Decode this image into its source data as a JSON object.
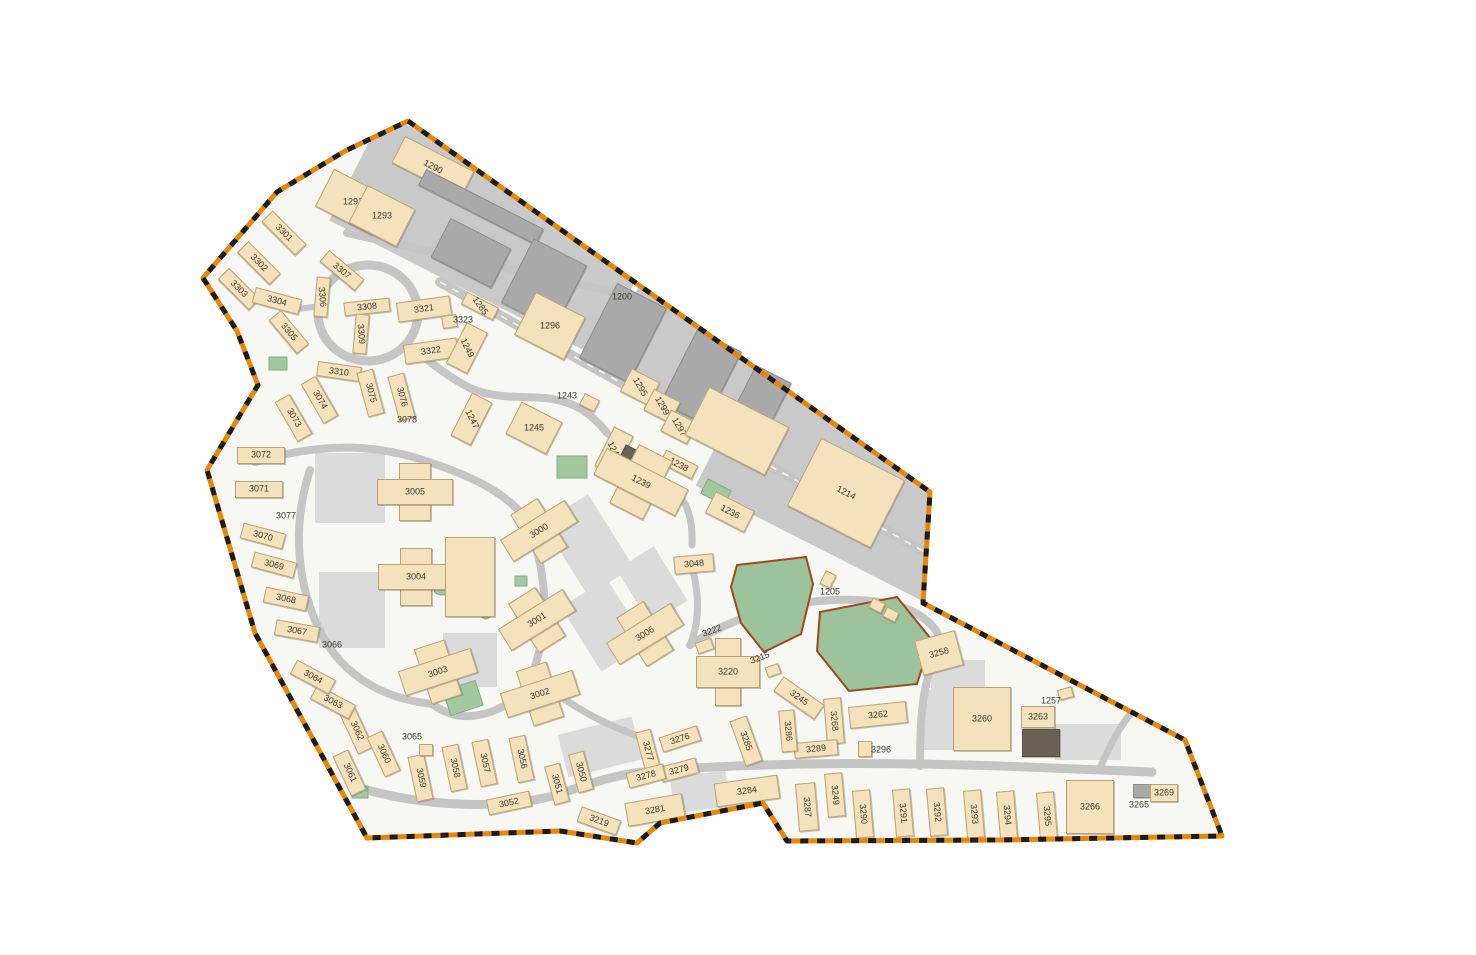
{
  "title": "Installation base site map with numbered buildings and dashed boundary",
  "colors": {
    "boundary_orange": "#e8860b",
    "boundary_black": "#1c1c1c",
    "ground": "#f7f7f3",
    "industrial_gray": "#c9c9c9",
    "road_gray": "#c5c5c5",
    "parking_gray": "#dbdbdb",
    "building_tan": "#f3e2bb",
    "building_border": "#b9a376",
    "warehouse_gray": "#a9a9a9",
    "dark_building": "#6b6257",
    "field_green": "#9cc39b",
    "field_border": "#9c4a1f",
    "label_text": "#3e3a31"
  },
  "map": {
    "buildings": [
      {
        "t": "1290",
        "x": 432,
        "y": 166,
        "w": 76,
        "h": 28,
        "r": 27,
        "la": 27
      },
      {
        "t": "1291",
        "x": 352,
        "y": 201,
        "w": 62,
        "h": 40,
        "r": 27,
        "la": 0
      },
      {
        "t": "1293",
        "x": 381,
        "y": 215,
        "w": 52,
        "h": 40,
        "r": 27,
        "la": 0
      },
      {
        "t": "",
        "x": 480,
        "y": 206,
        "w": 130,
        "h": 16,
        "r": 27,
        "k": "g"
      },
      {
        "t": "",
        "x": 470,
        "y": 252,
        "w": 66,
        "h": 42,
        "r": 27,
        "k": "g"
      },
      {
        "t": "",
        "x": 543,
        "y": 283,
        "w": 58,
        "h": 70,
        "r": 27,
        "k": "g"
      },
      {
        "t": "",
        "x": 622,
        "y": 332,
        "w": 54,
        "h": 82,
        "r": 27,
        "k": "g"
      },
      {
        "t": "",
        "x": 700,
        "y": 376,
        "w": 48,
        "h": 80,
        "r": 27,
        "k": "g"
      },
      {
        "t": "",
        "x": 756,
        "y": 406,
        "w": 38,
        "h": 72,
        "r": 27,
        "k": "g"
      },
      {
        "t": "3301",
        "x": 283,
        "y": 232,
        "w": 46,
        "h": 14,
        "r": 45,
        "la": 45
      },
      {
        "t": "3302",
        "x": 258,
        "y": 262,
        "w": 44,
        "h": 14,
        "r": 45,
        "la": 45
      },
      {
        "t": "3303",
        "x": 238,
        "y": 288,
        "w": 42,
        "h": 14,
        "r": 45,
        "la": 45
      },
      {
        "t": "3304",
        "x": 276,
        "y": 300,
        "w": 46,
        "h": 14,
        "r": 15,
        "la": 15
      },
      {
        "t": "3305",
        "x": 288,
        "y": 331,
        "w": 42,
        "h": 14,
        "r": 50,
        "la": 50
      },
      {
        "t": "3307",
        "x": 341,
        "y": 269,
        "w": 44,
        "h": 13,
        "r": 40,
        "la": 40
      },
      {
        "t": "3306",
        "x": 321,
        "y": 296,
        "w": 12,
        "h": 38,
        "r": 5,
        "la": 85
      },
      {
        "t": "3308",
        "x": 366,
        "y": 306,
        "w": 44,
        "h": 12,
        "r": -6,
        "la": -6
      },
      {
        "t": "3309",
        "x": 360,
        "y": 333,
        "w": 12,
        "h": 38,
        "r": 5,
        "la": 85
      },
      {
        "t": "3310",
        "x": 338,
        "y": 370,
        "w": 42,
        "h": 13,
        "r": 8,
        "la": 8
      },
      {
        "t": "3321",
        "x": 423,
        "y": 308,
        "w": 52,
        "h": 18,
        "r": -8,
        "la": -8
      },
      {
        "t": "",
        "x": 448,
        "y": 320,
        "w": 13,
        "h": 11,
        "r": -8
      },
      {
        "t": "3323",
        "x": 463,
        "y": 320,
        "k": "l",
        "la": 0
      },
      {
        "t": "3322",
        "x": 430,
        "y": 350,
        "w": 52,
        "h": 18,
        "r": -8,
        "la": -8
      },
      {
        "t": "1249",
        "x": 466,
        "y": 347,
        "w": 22,
        "h": 44,
        "r": 27,
        "la": 64
      },
      {
        "t": "1285",
        "x": 479,
        "y": 305,
        "w": 34,
        "h": 12,
        "r": 27,
        "la": 55
      },
      {
        "t": "1296",
        "x": 549,
        "y": 325,
        "w": 54,
        "h": 46,
        "r": 27,
        "la": 0
      },
      {
        "t": "1200",
        "x": 622,
        "y": 297,
        "k": "l",
        "la": 0
      },
      {
        "t": "1295",
        "x": 639,
        "y": 386,
        "w": 30,
        "h": 24,
        "r": 27,
        "la": 60
      },
      {
        "t": "1299",
        "x": 661,
        "y": 405,
        "w": 28,
        "h": 22,
        "r": 27,
        "la": 60
      },
      {
        "t": "1297",
        "x": 678,
        "y": 426,
        "w": 28,
        "h": 22,
        "r": 27,
        "la": 60
      },
      {
        "t": "1243",
        "x": 567,
        "y": 396,
        "k": "l",
        "la": 0
      },
      {
        "t": "",
        "x": 588,
        "y": 401,
        "w": 15,
        "h": 11,
        "r": 27
      },
      {
        "t": "1247",
        "x": 470,
        "y": 418,
        "w": 21,
        "h": 46,
        "r": 27,
        "la": 64
      },
      {
        "t": "1245",
        "x": 533,
        "y": 427,
        "w": 44,
        "h": 34,
        "r": 27,
        "la": 0
      },
      {
        "t": "1240",
        "x": 613,
        "y": 450,
        "w": 20,
        "h": 42,
        "r": 27,
        "la": 64
      },
      {
        "t": "",
        "x": 627,
        "y": 457,
        "w": 15,
        "h": 20,
        "r": 27,
        "k": "d"
      },
      {
        "t": "1238",
        "x": 678,
        "y": 463,
        "w": 34,
        "h": 13,
        "r": 27,
        "la": 27
      },
      {
        "t": "1239",
        "x": 641,
        "y": 482,
        "w": 92,
        "h": 66,
        "r": 27,
        "k": "c",
        "la": 27
      },
      {
        "t": "1236",
        "x": 729,
        "y": 511,
        "w": 42,
        "h": 22,
        "r": 27,
        "la": 27
      },
      {
        "t": "",
        "x": 736,
        "y": 430,
        "w": 88,
        "h": 52,
        "r": 27
      },
      {
        "t": "1214",
        "x": 845,
        "y": 492,
        "w": 92,
        "h": 74,
        "r": 27,
        "la": 27
      },
      {
        "t": "3048",
        "x": 693,
        "y": 563,
        "w": 38,
        "h": 16,
        "r": -5,
        "la": -5
      },
      {
        "t": "1205",
        "x": 830,
        "y": 592,
        "k": "l",
        "la": 0
      },
      {
        "t": "",
        "x": 827,
        "y": 578,
        "w": 10,
        "h": 13,
        "r": 27
      },
      {
        "t": "",
        "x": 876,
        "y": 604,
        "w": 12,
        "h": 9,
        "r": 27
      },
      {
        "t": "",
        "x": 890,
        "y": 613,
        "w": 12,
        "h": 9,
        "r": 27
      },
      {
        "t": "3005",
        "x": 415,
        "y": 492,
        "w": 76,
        "h": 58,
        "r": 0,
        "k": "c",
        "la": 0
      },
      {
        "t": "3000",
        "x": 539,
        "y": 531,
        "w": 76,
        "h": 58,
        "r": -32,
        "k": "c",
        "la": -32
      },
      {
        "t": "3004",
        "x": 416,
        "y": 577,
        "w": 76,
        "h": 58,
        "r": 0,
        "k": "c",
        "la": 0
      },
      {
        "t": "3001",
        "x": 537,
        "y": 620,
        "w": 76,
        "h": 58,
        "r": -32,
        "k": "c",
        "la": -32
      },
      {
        "t": "3003",
        "x": 438,
        "y": 672,
        "w": 76,
        "h": 58,
        "r": -18,
        "k": "c",
        "la": -18
      },
      {
        "t": "3002",
        "x": 540,
        "y": 694,
        "w": 76,
        "h": 58,
        "r": -18,
        "k": "c",
        "la": -18
      },
      {
        "t": "3006",
        "x": 645,
        "y": 634,
        "w": 76,
        "h": 58,
        "r": -32,
        "k": "c",
        "la": -32
      },
      {
        "t": "",
        "x": 469,
        "y": 576,
        "w": 48,
        "h": 78,
        "r": 0
      },
      {
        "t": "3222",
        "x": 712,
        "y": 631,
        "k": "l",
        "la": -20
      },
      {
        "t": "",
        "x": 703,
        "y": 645,
        "w": 15,
        "h": 10,
        "r": -20
      },
      {
        "t": "3215",
        "x": 760,
        "y": 658,
        "k": "l",
        "la": -20
      },
      {
        "t": "",
        "x": 772,
        "y": 669,
        "w": 12,
        "h": 9,
        "r": -20
      },
      {
        "t": "3220",
        "x": 728,
        "y": 672,
        "w": 64,
        "h": 68,
        "r": 0,
        "k": "c",
        "la": 0
      },
      {
        "t": "3245",
        "x": 798,
        "y": 697,
        "w": 48,
        "h": 16,
        "r": 35,
        "la": 35
      },
      {
        "t": "3268",
        "x": 833,
        "y": 720,
        "w": 16,
        "h": 44,
        "r": -5,
        "la": 85
      },
      {
        "t": "3262",
        "x": 877,
        "y": 714,
        "w": 56,
        "h": 20,
        "r": -6,
        "la": -6
      },
      {
        "t": "3258",
        "x": 938,
        "y": 652,
        "w": 40,
        "h": 34,
        "r": -15,
        "la": -15
      },
      {
        "t": "3260",
        "x": 981,
        "y": 718,
        "w": 56,
        "h": 62,
        "r": 0,
        "la": 0
      },
      {
        "t": "3263",
        "x": 1037,
        "y": 716,
        "w": 32,
        "h": 20,
        "r": 0,
        "la": 0
      },
      {
        "t": "",
        "x": 1040,
        "y": 742,
        "w": 36,
        "h": 26,
        "r": 0,
        "k": "d"
      },
      {
        "t": "1257",
        "x": 1051,
        "y": 701,
        "k": "l",
        "la": 0
      },
      {
        "t": "",
        "x": 1064,
        "y": 692,
        "w": 13,
        "h": 9,
        "r": -15
      },
      {
        "t": "3289",
        "x": 815,
        "y": 748,
        "w": 42,
        "h": 14,
        "r": -5,
        "la": -5
      },
      {
        "t": "3296",
        "x": 881,
        "y": 750,
        "k": "l",
        "la": 0
      },
      {
        "t": "",
        "x": 864,
        "y": 748,
        "w": 12,
        "h": 14,
        "r": 0
      },
      {
        "t": "3286",
        "x": 787,
        "y": 730,
        "w": 14,
        "h": 40,
        "r": -5,
        "la": 85
      },
      {
        "t": "3285",
        "x": 745,
        "y": 740,
        "w": 16,
        "h": 46,
        "r": -20,
        "la": 70
      },
      {
        "t": "3276",
        "x": 679,
        "y": 738,
        "w": 38,
        "h": 14,
        "r": -18,
        "la": -18
      },
      {
        "t": "3277",
        "x": 647,
        "y": 750,
        "w": 14,
        "h": 40,
        "r": -15,
        "la": 75
      },
      {
        "t": "3279",
        "x": 678,
        "y": 769,
        "w": 36,
        "h": 14,
        "r": -15,
        "la": -15
      },
      {
        "t": "3278",
        "x": 645,
        "y": 775,
        "w": 36,
        "h": 14,
        "r": -15,
        "la": -15
      },
      {
        "t": "3281",
        "x": 654,
        "y": 809,
        "w": 56,
        "h": 22,
        "r": -10,
        "la": -10
      },
      {
        "t": "3284",
        "x": 746,
        "y": 790,
        "w": 62,
        "h": 22,
        "r": -8,
        "la": -8
      },
      {
        "t": "3287",
        "x": 806,
        "y": 806,
        "w": 18,
        "h": 46,
        "r": -5,
        "la": 85
      },
      {
        "t": "3249",
        "x": 834,
        "y": 794,
        "w": 16,
        "h": 42,
        "r": -5,
        "la": 85
      },
      {
        "t": "3290",
        "x": 862,
        "y": 813,
        "w": 16,
        "h": 46,
        "r": -5,
        "la": 85
      },
      {
        "t": "3291",
        "x": 902,
        "y": 812,
        "w": 16,
        "h": 46,
        "r": -5,
        "la": 85
      },
      {
        "t": "3292",
        "x": 936,
        "y": 811,
        "w": 16,
        "h": 46,
        "r": -5,
        "la": 85
      },
      {
        "t": "3293",
        "x": 973,
        "y": 813,
        "w": 16,
        "h": 46,
        "r": -5,
        "la": 85
      },
      {
        "t": "3294",
        "x": 1006,
        "y": 814,
        "w": 16,
        "h": 46,
        "r": -5,
        "la": 85
      },
      {
        "t": "3295",
        "x": 1046,
        "y": 815,
        "w": 16,
        "h": 46,
        "r": -5,
        "la": 85
      },
      {
        "t": "3266",
        "x": 1089,
        "y": 806,
        "w": 46,
        "h": 52,
        "r": 0,
        "la": 0
      },
      {
        "t": "3265",
        "x": 1139,
        "y": 805,
        "k": "l",
        "la": 0
      },
      {
        "t": "",
        "x": 1141,
        "y": 790,
        "w": 16,
        "h": 12,
        "r": 0,
        "k": "g"
      },
      {
        "t": "3269",
        "x": 1163,
        "y": 792,
        "w": 26,
        "h": 16,
        "r": 0,
        "la": 0
      },
      {
        "t": "3219",
        "x": 598,
        "y": 820,
        "w": 40,
        "h": 14,
        "r": 20,
        "la": 20
      },
      {
        "t": "3052",
        "x": 508,
        "y": 802,
        "w": 42,
        "h": 14,
        "r": -12,
        "la": -12
      },
      {
        "t": "3051",
        "x": 556,
        "y": 783,
        "w": 14,
        "h": 38,
        "r": -15,
        "la": 75
      },
      {
        "t": "3050",
        "x": 580,
        "y": 771,
        "w": 14,
        "h": 38,
        "r": -15,
        "la": 75
      },
      {
        "t": "3059",
        "x": 419,
        "y": 777,
        "w": 15,
        "h": 44,
        "r": -12,
        "la": 78
      },
      {
        "t": "3058",
        "x": 453,
        "y": 767,
        "w": 15,
        "h": 44,
        "r": -12,
        "la": 78
      },
      {
        "t": "3057",
        "x": 483,
        "y": 762,
        "w": 15,
        "h": 44,
        "r": -12,
        "la": 78
      },
      {
        "t": "3056",
        "x": 520,
        "y": 758,
        "w": 15,
        "h": 44,
        "r": -12,
        "la": 78
      },
      {
        "t": "3065",
        "x": 412,
        "y": 737,
        "k": "l",
        "la": 0
      },
      {
        "t": "",
        "x": 425,
        "y": 749,
        "w": 12,
        "h": 10,
        "r": 0
      },
      {
        "t": "3062",
        "x": 355,
        "y": 730,
        "w": 15,
        "h": 42,
        "r": -25,
        "la": 65
      },
      {
        "t": "3060",
        "x": 382,
        "y": 753,
        "w": 15,
        "h": 42,
        "r": -25,
        "la": 65
      },
      {
        "t": "3061",
        "x": 348,
        "y": 772,
        "w": 15,
        "h": 42,
        "r": -25,
        "la": 65
      },
      {
        "t": "3063",
        "x": 332,
        "y": 701,
        "w": 42,
        "h": 14,
        "r": 28,
        "la": 28
      },
      {
        "t": "3064",
        "x": 312,
        "y": 676,
        "w": 42,
        "h": 14,
        "r": 28,
        "la": 28
      },
      {
        "t": "3066",
        "x": 332,
        "y": 645,
        "k": "l",
        "la": 0
      },
      {
        "t": "3067",
        "x": 296,
        "y": 630,
        "w": 42,
        "h": 14,
        "r": 10,
        "la": 10
      },
      {
        "t": "3068",
        "x": 285,
        "y": 598,
        "w": 42,
        "h": 14,
        "r": 12,
        "la": 12
      },
      {
        "t": "3069",
        "x": 273,
        "y": 564,
        "w": 42,
        "h": 14,
        "r": 15,
        "la": 15
      },
      {
        "t": "3070",
        "x": 262,
        "y": 535,
        "w": 42,
        "h": 14,
        "r": 15,
        "la": 15
      },
      {
        "t": "3077",
        "x": 286,
        "y": 516,
        "k": "l",
        "la": 0
      },
      {
        "t": "3071",
        "x": 258,
        "y": 488,
        "w": 46,
        "h": 15,
        "r": 0,
        "la": 0
      },
      {
        "t": "3072",
        "x": 260,
        "y": 454,
        "w": 46,
        "h": 15,
        "r": 0,
        "la": 0
      },
      {
        "t": "3073",
        "x": 292,
        "y": 417,
        "w": 15,
        "h": 44,
        "r": -30,
        "la": 60
      },
      {
        "t": "3074",
        "x": 318,
        "y": 399,
        "w": 15,
        "h": 44,
        "r": -30,
        "la": 60
      },
      {
        "t": "3075",
        "x": 369,
        "y": 392,
        "w": 15,
        "h": 44,
        "r": -15,
        "la": 75
      },
      {
        "t": "3076",
        "x": 400,
        "y": 396,
        "w": 15,
        "h": 44,
        "r": -15,
        "la": 75
      },
      {
        "t": "3078",
        "x": 407,
        "y": 420,
        "k": "l",
        "la": 0
      }
    ]
  }
}
